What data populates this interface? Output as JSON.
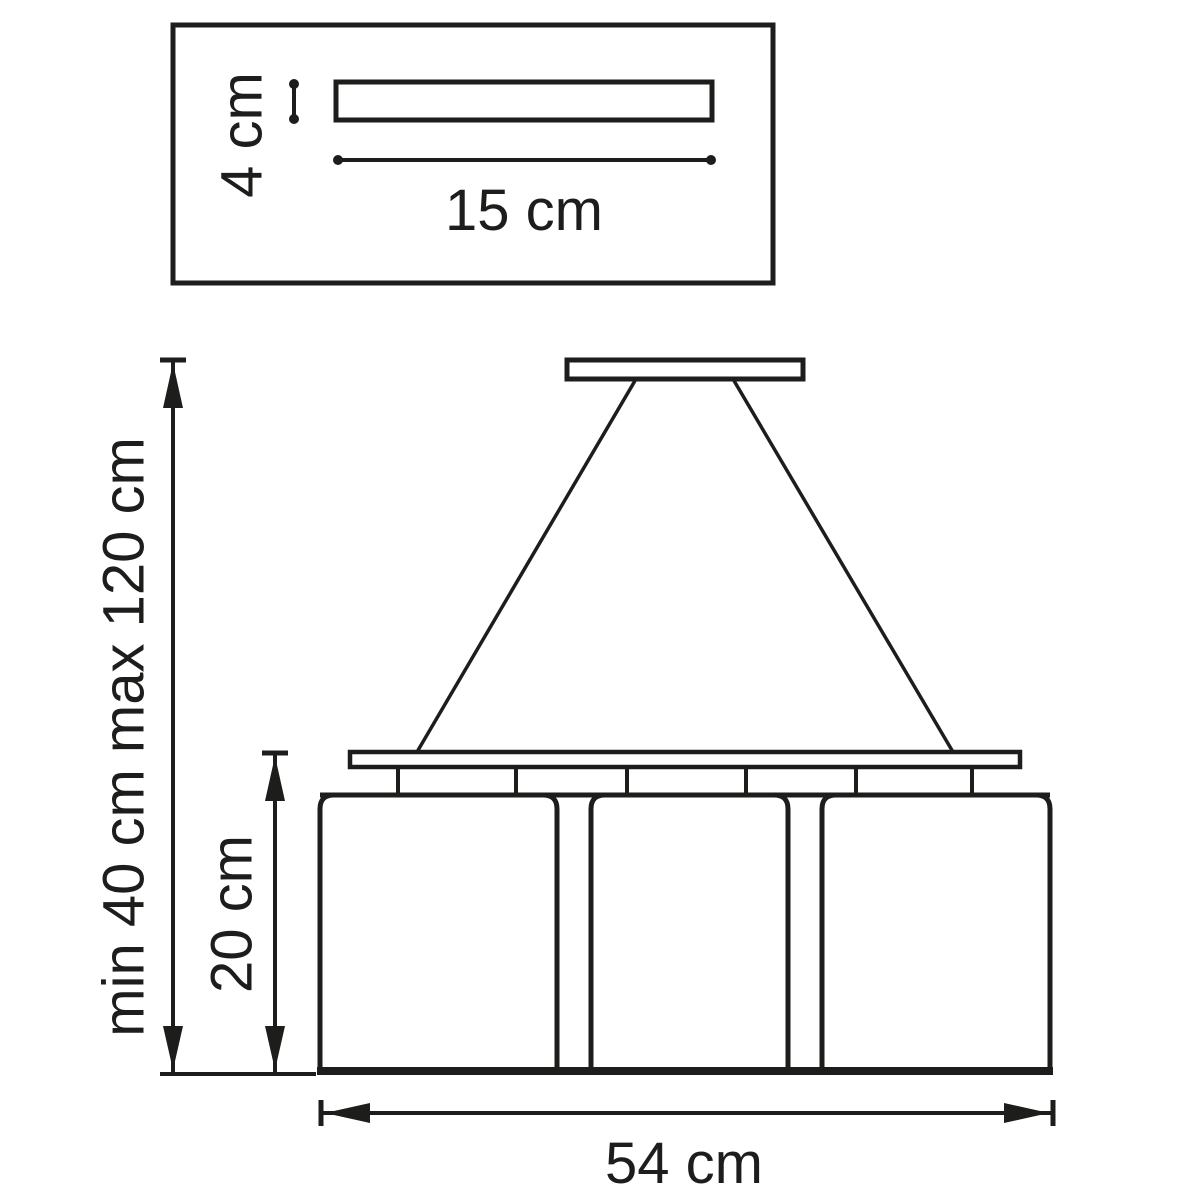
{
  "figure": {
    "type": "technical-dimension-drawing",
    "subject": "pendant lamp with three shades and ceiling canopy",
    "background_color": "#ffffff",
    "line_color": "#1d1d1b",
    "inset": {
      "canopy_height_label": "4 cm",
      "canopy_width_label": "15 cm"
    },
    "main": {
      "suspension_height_label": "min 40 cm max 120 cm",
      "shade_height_label": "20 cm",
      "fixture_width_label": "54 cm"
    }
  }
}
